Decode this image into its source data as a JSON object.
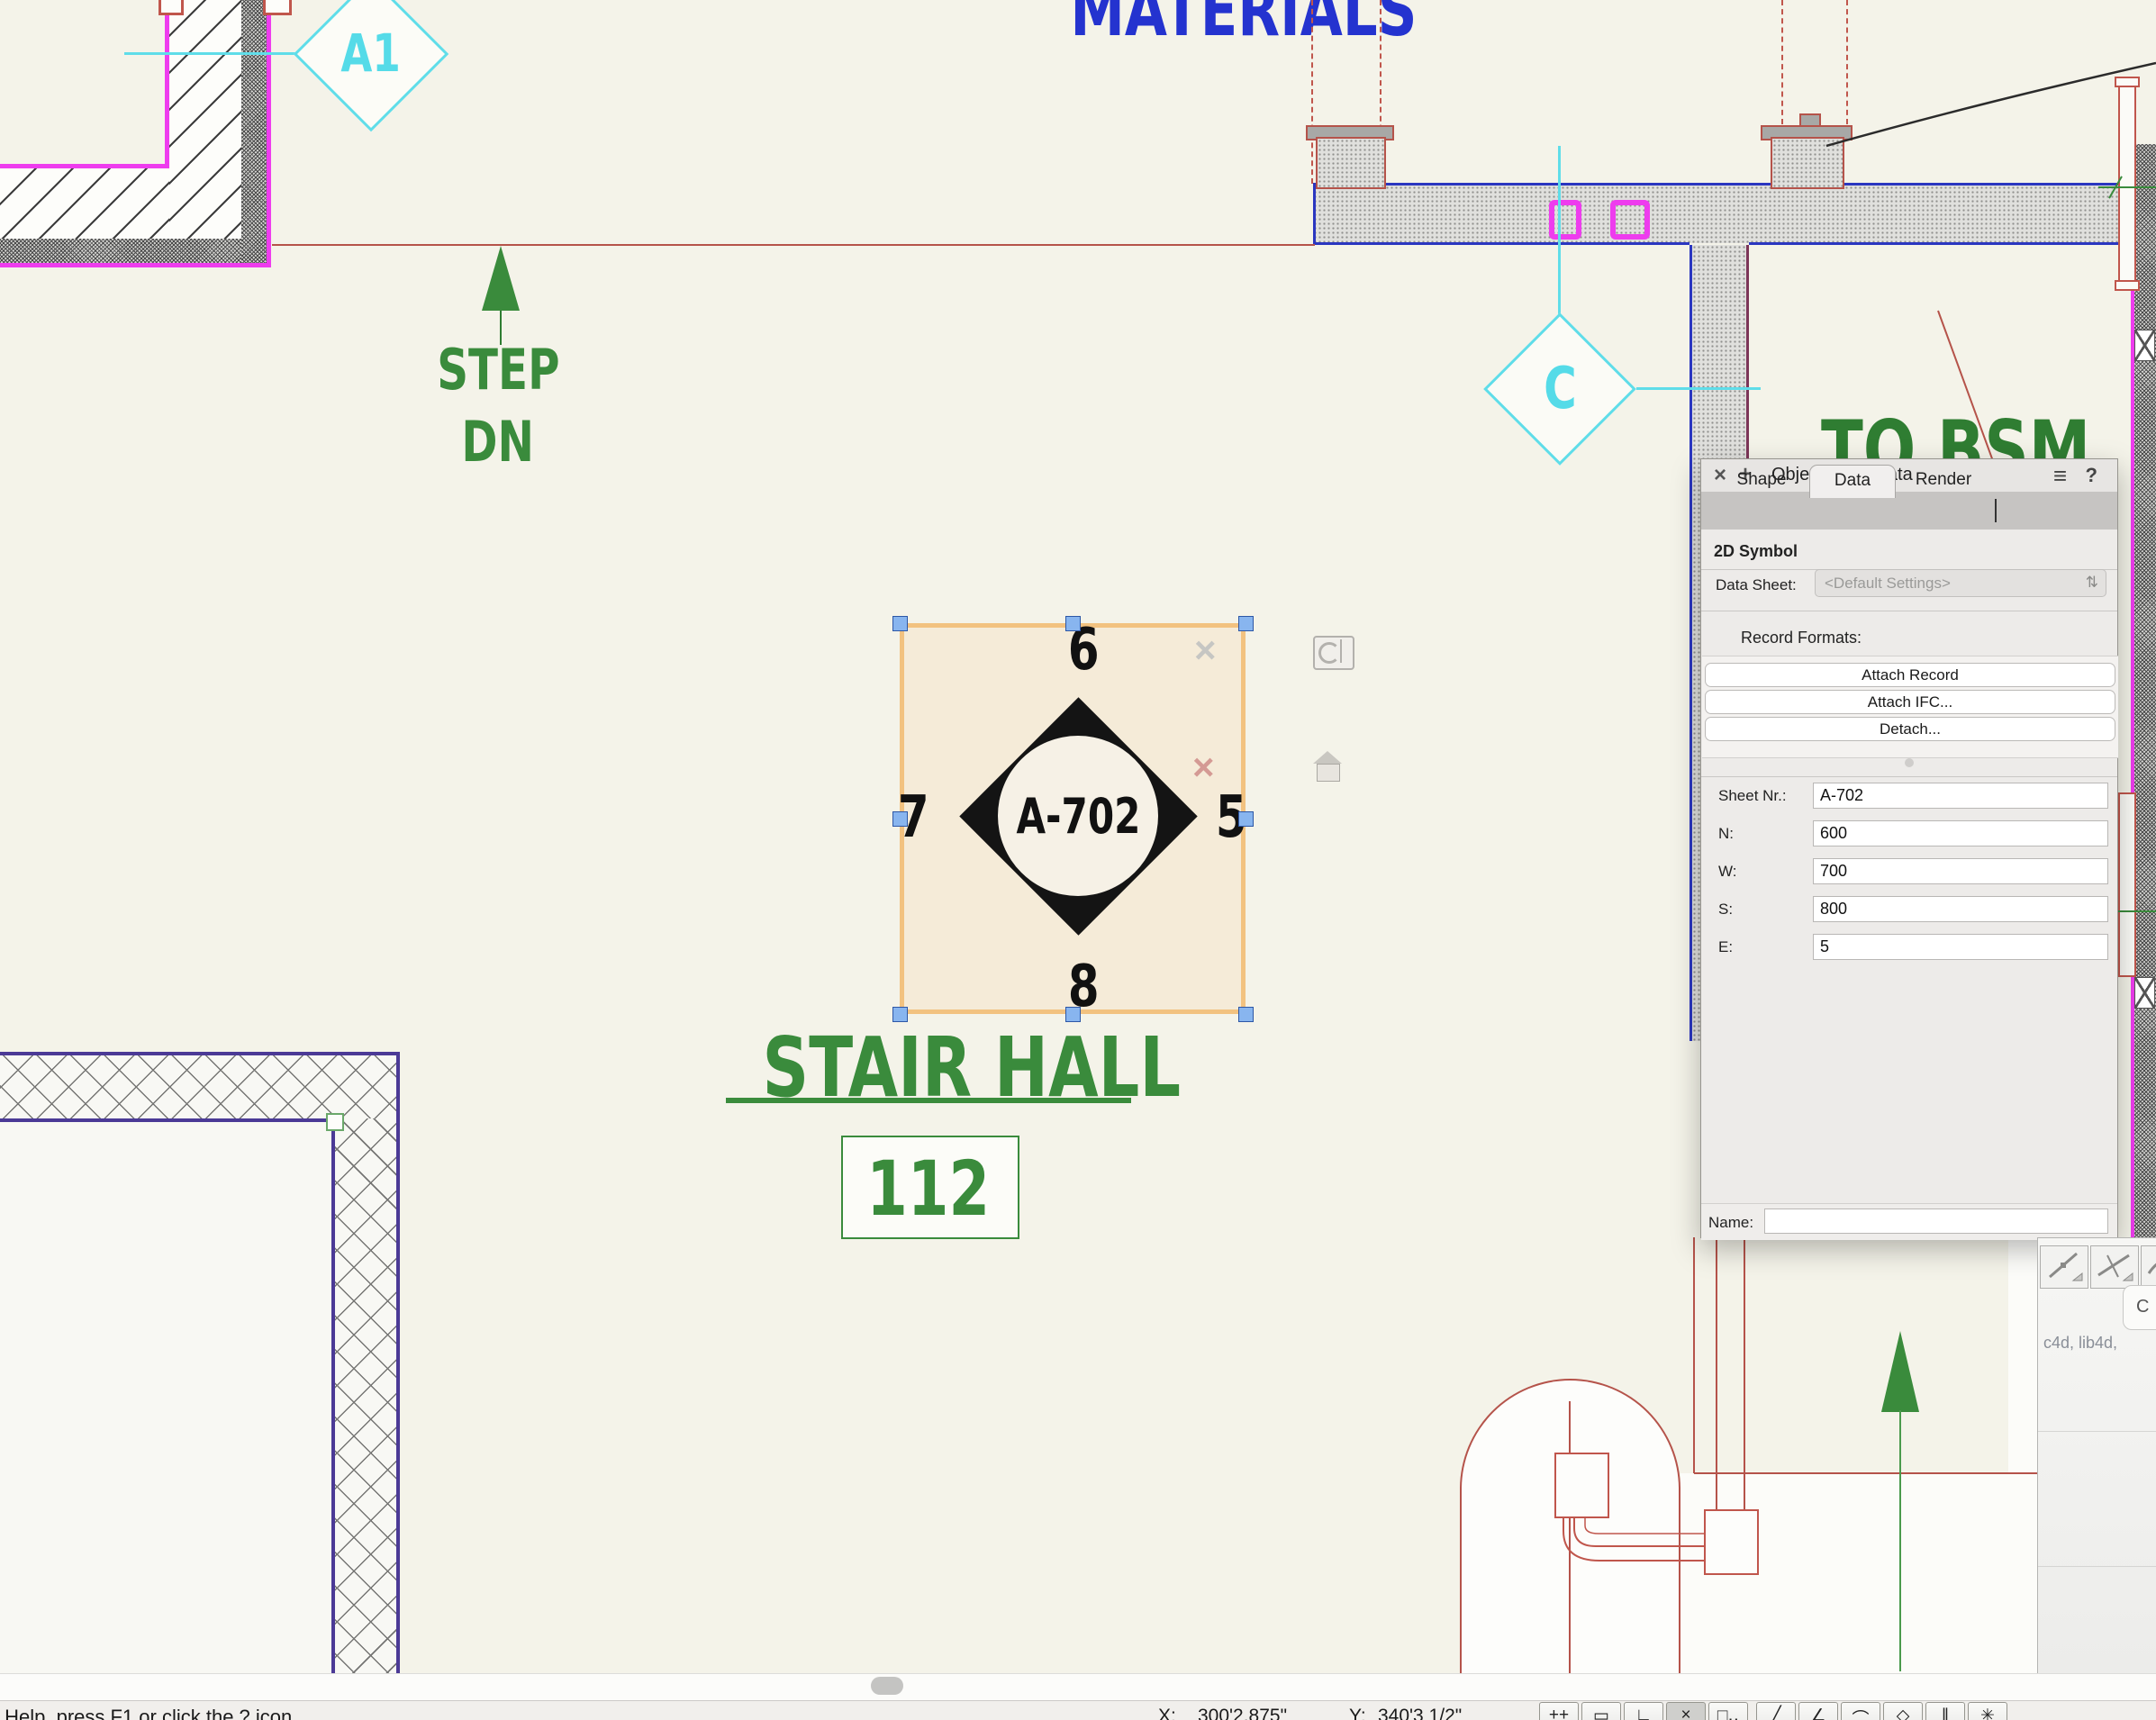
{
  "drawing": {
    "materials_label": "MATERIALS",
    "to_bsmt_label": "TO BSM",
    "stair_hall_label": "STAIR HALL",
    "room_number": "112",
    "step_down_line1": "STEP",
    "step_down_line2": "DN",
    "marker_a1": "A1",
    "marker_c": "C",
    "section_marker": {
      "sheet_number": "A-702",
      "num_top": "6",
      "num_left": "7",
      "num_right": "5",
      "num_bottom": "8"
    }
  },
  "canvas_icons": {
    "deselect_x": "×",
    "delete_x": "×"
  },
  "object_info_palette": {
    "close_icon": "×",
    "dock_icon": "+",
    "title": "Object Info - Data",
    "menu_icon": "≡",
    "help_icon": "?",
    "tabs": [
      "Shape",
      "Data",
      "Render"
    ],
    "active_tab": "Data",
    "section_title": "2D Symbol",
    "data_sheet_label": "Data Sheet:",
    "data_sheet_value": "<Default Settings>",
    "data_sheet_stepper_icon": "⇅",
    "record_formats_label": "Record Formats:",
    "attach_record_button": "Attach Record",
    "attach_ifc_button": "Attach IFC...",
    "detach_button": "Detach...",
    "fields": [
      {
        "label": "Sheet Nr.:",
        "value": "A-702"
      },
      {
        "label": "N:",
        "value": "600"
      },
      {
        "label": "W:",
        "value": "700"
      },
      {
        "label": "S:",
        "value": "800"
      },
      {
        "label": "E:",
        "value": "5"
      }
    ],
    "name_label": "Name:",
    "name_value": ""
  },
  "resource_panel": {
    "tab_label": "C",
    "file_types_text": "c4d, lib4d,"
  },
  "status_bar": {
    "help_text": "For Help, press F1 or click the ? icon",
    "x_label": "X:",
    "x_value": "300'2.875\"",
    "y_label": "Y:",
    "y_value": "340'3 1/2\"",
    "tools": [
      "++",
      "▭",
      "∟",
      "×",
      "□‥",
      "╱",
      "∠",
      "⌒",
      "◇",
      "∥",
      "✳"
    ]
  },
  "colors": {
    "cad_green": "#3a8b3c",
    "cad_blue": "#2433cf",
    "cad_cyan": "#5fdde9",
    "wall_magenta": "#ee3cee",
    "wall_purple": "#4b3a96",
    "line_red": "#b5534a",
    "selection_orange": "#f2c280",
    "handle_blue": "#85b4f0"
  }
}
